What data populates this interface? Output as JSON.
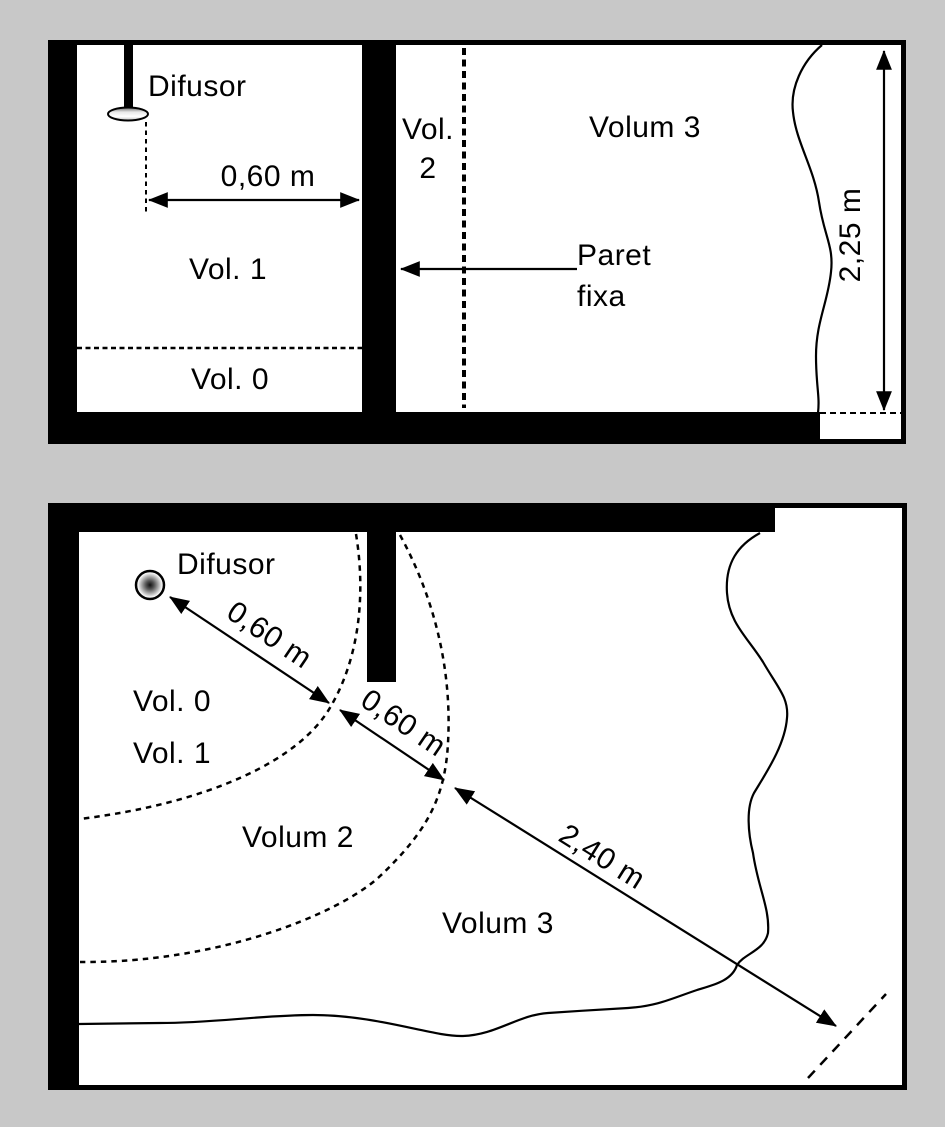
{
  "colors": {
    "page_background": "#c8c8c8",
    "paper": "#ffffff",
    "ink": "#000000"
  },
  "icons": {
    "shower_diffuser_elevation": "pipe-with-shaded-ellipse-head",
    "diffuser_plan": "circle-with-dark-radial-center"
  },
  "top_diagram": {
    "title_hint": "elevation view of shower volumes",
    "labels": {
      "difusor": "Difusor",
      "dim_width": "0,60 m",
      "vol1": "Vol. 1",
      "vol0": "Vol. 0",
      "vol2_line1": "Vol.",
      "vol2_line2": "2",
      "volum3": "Volum 3",
      "paret_line1": "Paret",
      "paret_line2": "fixa",
      "dim_height": "2,25 m"
    }
  },
  "bottom_diagram": {
    "title_hint": "plan view of shower volumes",
    "labels": {
      "difusor": "Difusor",
      "vol0": "Vol. 0",
      "vol1": "Vol. 1",
      "volum2": "Volum 2",
      "volum3": "Volum 3",
      "dim_a": "0,60 m",
      "dim_b": "0,60 m",
      "dim_c": "2,40 m"
    }
  }
}
